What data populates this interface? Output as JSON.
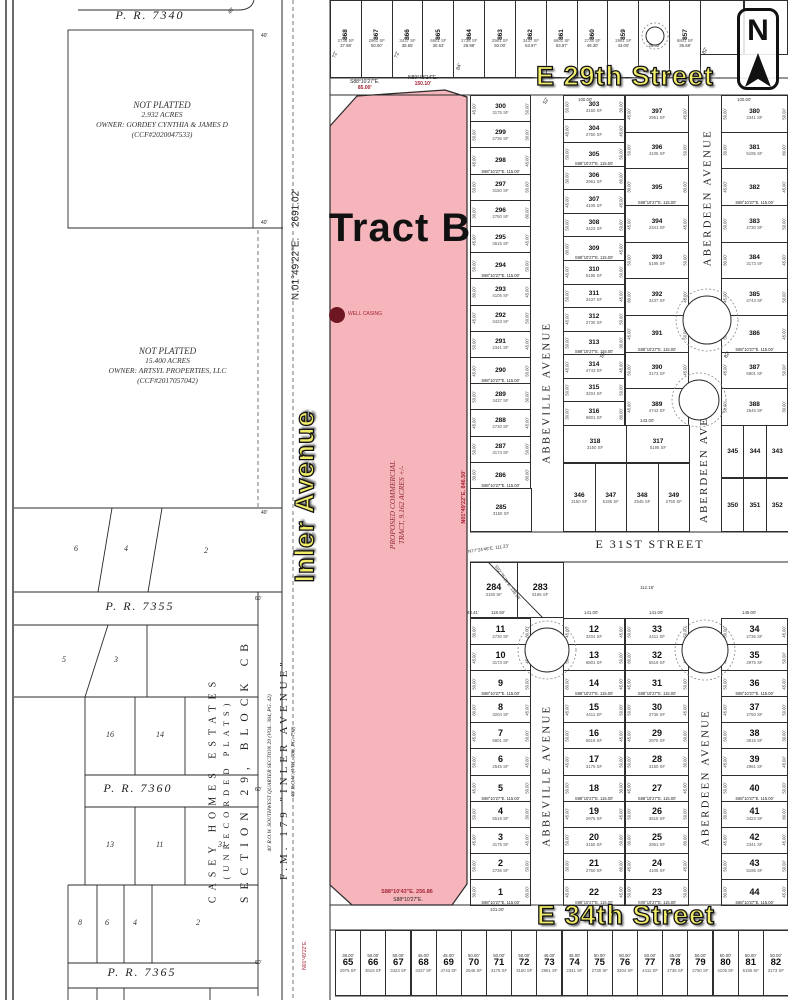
{
  "palette": {
    "pink": "#f6b5ba",
    "yellow": "#f1ec69",
    "red": "#a42336",
    "maroon": "#6e1722",
    "line": "#2b2b2b"
  },
  "compass": {
    "letter": "N"
  },
  "tract_b": {
    "label": "Tract B",
    "proposed_line1": "PROPOSED COMMERCIAL",
    "proposed_line2": "TRACT, 9.162 ACRES +/-",
    "well_label": "WELL CASING",
    "bearing_top_left": "S88°10'27\"E.",
    "dist_top_left": "85.00'",
    "bearing_top_right": "N89°43'14\"E.",
    "dist_top_right": "150.10'",
    "bearing_east": "N01°49'22\"E.  846.50'",
    "bearing_bottom": "S88°10'43\"E.  256.86",
    "bearing_bottom_2": "S88°10'27\"E."
  },
  "west": {
    "pr_7340": "P. R. 7340",
    "pr_7355": "P. R. 7355",
    "pr_7360": "P. R. 7360",
    "pr_7365": "P. R. 7365",
    "parcel_a": [
      "NOT PLATTED",
      "2.932 ACRES",
      "OWNER: GORDEY CYNTHIA & JAMES D",
      "(CCF#2020047533)"
    ],
    "parcel_b": [
      "NOT PLATTED",
      "15.400 ACRES",
      "OWNER: ARTSYL PROPERTIES, LLC",
      "(CCF#2017057042)"
    ],
    "rows": {
      "row1": [
        "6",
        "4",
        "2"
      ],
      "row2": [
        "5",
        "3"
      ],
      "row3": [
        "16",
        "14"
      ],
      "row4": [
        "13",
        "11",
        "31"
      ],
      "row5": [
        "8",
        "6",
        "4",
        "2"
      ]
    }
  },
  "corridor": {
    "bearing": "N.01°49'22\"E.   2691.02'",
    "street_label": "Inler Avenue",
    "casey_1": "CASEY HOMES ESTATES",
    "casey_2": "(UNRECORDED PLATS)",
    "section": "SECTION 29, BLOCK CB",
    "fm": "F.M. 179 \"INLER AVENUE\"",
    "row_note_1": "40' R.O.W. SOUTHWEST QUARTER SECTION 29 (VOL. 384, PG. 42)",
    "row_note_2": "40' R.O.W. (VOL. 386, PG. 792)"
  },
  "streets": {
    "e29": "E 29th Street",
    "e31": "E 31ST STREET",
    "e34": "E 34th Street",
    "abbeville_upper": "ABBEVILLE AVENUE",
    "abbeville_lower": "ABBEVILLE AVENUE",
    "aberdeen_upper": "ABERDEEN AVENUE",
    "aberdeen_mid": "ABERDEEN AVE",
    "aberdeen_lower": "ABERDEEN AVENUE"
  },
  "grid": {
    "sep_label": "S88°10'27\"E.  115.00'",
    "sf_pool": [
      "3175 SF",
      "2736 SF",
      "2975 SF",
      "3150 SF",
      "2750 SF",
      "3615 SF",
      "2961 SF",
      "4105 SF",
      "3423 SF",
      "2341 SF",
      "5195 SF",
      "3437 SF",
      "2730 SF",
      "3173 SF",
      "4743 SF",
      "3204 SF",
      "6801 SF",
      "2545 SF",
      "4411 SF",
      "5519 SF"
    ],
    "dim_pool": [
      "45.00'",
      "50.00'",
      "45.00'",
      "50.00'",
      "30.00'",
      "45.00'",
      "50.00'",
      "80.00'",
      "45.00'",
      "50.00'"
    ],
    "columns": {
      "colA": [
        "300",
        "299",
        "298",
        "297",
        "296",
        "295",
        "294",
        "293",
        "292",
        "291",
        "290",
        "289",
        "288",
        "287",
        "286"
      ],
      "colB": [
        "303",
        "304",
        "305",
        "306",
        "307",
        "308",
        "309",
        "310",
        "311",
        "312",
        "313",
        "314",
        "315",
        "316"
      ],
      "colC": [
        "397",
        "396",
        "395",
        "394",
        "393",
        "392",
        "391",
        "390",
        "389"
      ],
      "colD": [
        "380",
        "381",
        "382",
        "383",
        "384",
        "385",
        "386",
        "387",
        "388"
      ],
      "colA2": [
        "11",
        "10",
        "9",
        "8",
        "7",
        "6",
        "5",
        "4",
        "3",
        "2",
        "1"
      ],
      "colB2": [
        "12",
        "13",
        "14",
        "15",
        "16",
        "17",
        "18",
        "19",
        "20",
        "21",
        "22"
      ],
      "colC2": [
        "33",
        "32",
        "31",
        "30",
        "29",
        "28",
        "27",
        "26",
        "25",
        "24",
        "23"
      ],
      "colD2": [
        "34",
        "35",
        "36",
        "37",
        "38",
        "39",
        "40",
        "41",
        "42",
        "43",
        "44"
      ],
      "lot285": [
        "285"
      ],
      "band318": [
        "318",
        "317"
      ],
      "rowE": [
        "345",
        "344",
        "343"
      ],
      "rowF": [
        "346",
        "347",
        "348",
        "349"
      ],
      "rowG": [
        "350",
        "351",
        "352"
      ],
      "diag": [
        "284",
        "283"
      ]
    },
    "top_row": {
      "numbers": [
        "868",
        "867",
        "866",
        "865",
        "864",
        "863",
        "862",
        "861",
        "860",
        "859",
        "858",
        "857"
      ],
      "dims": [
        "37.98'",
        "50.00'",
        "38.65'",
        "30.63'",
        "29.98'",
        "50.00'",
        "63.97'",
        "63.97'",
        "49.30'",
        "43.00'",
        "36.00'",
        "36.68'"
      ]
    },
    "bottom_row": {
      "numbers": [
        "65",
        "66",
        "67",
        "68",
        "69",
        "70",
        "71",
        "72",
        "73",
        "74",
        "75",
        "76",
        "77",
        "78",
        "79",
        "80",
        "81",
        "82"
      ],
      "dims": [
        "38.00'",
        "50.00'",
        "50.00'",
        "45.00'",
        "45.00'",
        "50.00'",
        "50.00'",
        "50.00'",
        "45.00'",
        "45.00'",
        "50.00'",
        "50.00'",
        "50.00'",
        "45.00'",
        "50.00'",
        "50.00'",
        "50.00'",
        "50.00'"
      ]
    }
  },
  "annotations": [
    {
      "t": "40'",
      "x": 228,
      "y": 8,
      "r": -55
    },
    {
      "t": "40'",
      "x": 261,
      "y": 33,
      "r": 0
    },
    {
      "t": "40'",
      "x": 261,
      "y": 220,
      "r": 0
    },
    {
      "t": "40'",
      "x": 261,
      "y": 510,
      "r": 0
    },
    {
      "t": "60'",
      "x": 255,
      "y": 596,
      "r": 0
    },
    {
      "t": "60'",
      "x": 255,
      "y": 787,
      "r": 0
    },
    {
      "t": "60'",
      "x": 255,
      "y": 960,
      "r": 0
    },
    {
      "t": "72'",
      "x": 332,
      "y": 52,
      "r": -70
    },
    {
      "t": "72'",
      "x": 394,
      "y": 52,
      "r": -70
    },
    {
      "t": "84'",
      "x": 456,
      "y": 64,
      "r": -70
    },
    {
      "t": "82'",
      "x": 702,
      "y": 48,
      "r": -60
    },
    {
      "t": "52'",
      "x": 543,
      "y": 98,
      "r": -60
    },
    {
      "t": "82'",
      "x": 724,
      "y": 352,
      "r": -60
    },
    {
      "t": "52'",
      "x": 600,
      "y": 352,
      "r": -60
    },
    {
      "t": "S02°35'29\"E. 138.58'",
      "x": 487,
      "y": 580,
      "r": 55,
      "c": "tiny"
    },
    {
      "t": "N77°24'46\"E. 111.23'",
      "x": 468,
      "y": 546,
      "r": -8,
      "c": "tiny"
    },
    {
      "t": "N01°49'22\"E.",
      "x": 290,
      "y": 952,
      "r": -90,
      "c": "tinyred"
    },
    {
      "t": "48.41'",
      "x": 467,
      "y": 610,
      "r": 0,
      "c": "tiny"
    },
    {
      "t": "118.50'",
      "x": 491,
      "y": 610,
      "r": 0,
      "c": "tiny"
    },
    {
      "t": "141.00'",
      "x": 584,
      "y": 610,
      "r": 0,
      "c": "tiny"
    },
    {
      "t": "141.00'",
      "x": 649,
      "y": 610,
      "r": 0,
      "c": "tiny"
    },
    {
      "t": "145.00'",
      "x": 742,
      "y": 610,
      "r": 0,
      "c": "tiny"
    },
    {
      "t": "101.00'",
      "x": 490,
      "y": 907,
      "r": 0,
      "c": "tiny"
    },
    {
      "t": "100.00'",
      "x": 578,
      "y": 97,
      "r": 0,
      "c": "tiny"
    },
    {
      "t": "100.00'",
      "x": 737,
      "y": 97,
      "r": 0,
      "c": "tiny"
    },
    {
      "t": "143.00'",
      "x": 640,
      "y": 418,
      "r": 0,
      "c": "tiny"
    },
    {
      "t": "112.18'",
      "x": 640,
      "y": 585,
      "r": 0,
      "c": "tiny"
    }
  ]
}
